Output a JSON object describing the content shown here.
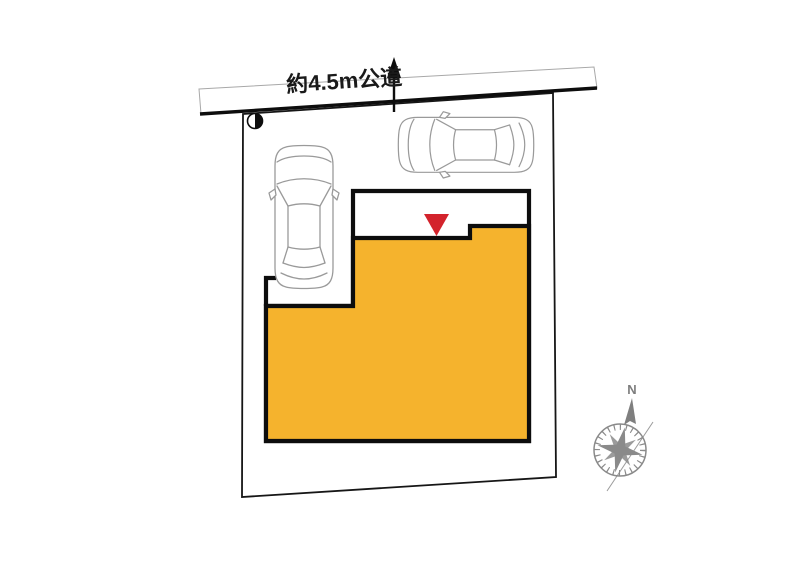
{
  "road": {
    "label": "約4.5m公道"
  },
  "compass": {
    "north_label": "N"
  },
  "icons": {
    "entrance_marker": "red-down-triangle",
    "survey_marker": "half-filled-circle",
    "road_direction_arrow": "up-arrow",
    "compass": "compass-rose"
  },
  "colors": {
    "building_fill": "#F5B32D",
    "road_fill": "#D8D8D8",
    "entrance_marker_red": "#D3232C",
    "outline_black": "#0D0D0D",
    "car_stroke": "#9A9A9A",
    "compass_gray": "#8A8A8A"
  }
}
